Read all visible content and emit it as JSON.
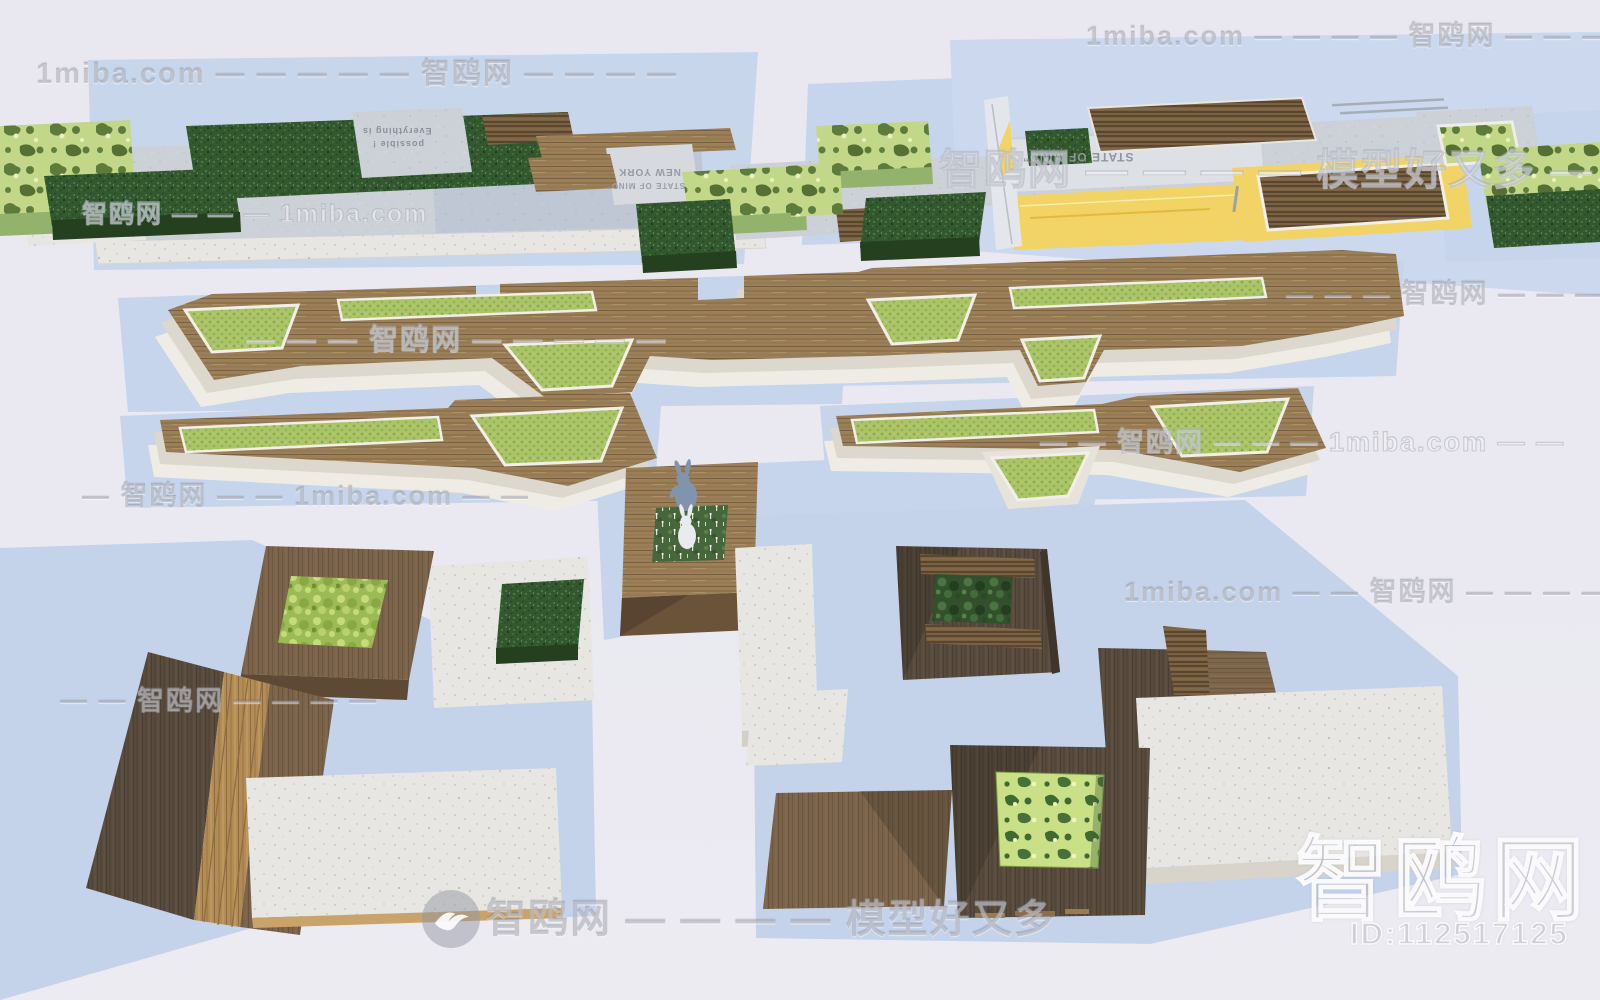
{
  "branding": {
    "site_name": "智鸥网",
    "site_domain": "1miba.com",
    "tagline": "模型好又多",
    "model_id": "ID:112517125",
    "logo_icon": "gull-icon"
  },
  "watermarks": [
    {
      "text": "1miba.com — — — — 智鸥网 — — — —",
      "x": 1086,
      "y": 14,
      "size": 27,
      "style": "gray"
    },
    {
      "text": "1miba.com — — — — — 智鸥网 — — — —",
      "x": 36,
      "y": 50,
      "size": 29,
      "style": "gray"
    },
    {
      "text": "智鸥网 — — — — 模型好又多 — —",
      "x": 940,
      "y": 136,
      "size": 42,
      "style": "outline"
    },
    {
      "text": "智鸥网 — — — 1miba.com",
      "x": 82,
      "y": 194,
      "size": 25,
      "style": "outline"
    },
    {
      "text": "— — — 智鸥网 — — — —",
      "x": 1286,
      "y": 272,
      "size": 27,
      "style": "gray"
    },
    {
      "text": "— — — 智鸥网 — — — — —",
      "x": 246,
      "y": 316,
      "size": 29,
      "style": "outline"
    },
    {
      "text": "— — 智鸥网 — — — 1miba.com — —",
      "x": 1040,
      "y": 420,
      "size": 27,
      "style": "outline"
    },
    {
      "text": "— 智鸥网 — — 1miba.com — —",
      "x": 82,
      "y": 474,
      "size": 27,
      "style": "gray"
    },
    {
      "text": "1miba.com — — 智鸥网 — — — —",
      "x": 1124,
      "y": 570,
      "size": 27,
      "style": "gray"
    },
    {
      "text": "— — 智鸥网 — — — —",
      "x": 60,
      "y": 678,
      "size": 27,
      "style": "gray"
    },
    {
      "text": "智鸥网 — — — — 模型好又多",
      "x": 486,
      "y": 886,
      "size": 40,
      "style": "gray"
    }
  ],
  "structure_labels": [
    {
      "text": "Everything is",
      "x": 362,
      "y": 126,
      "size": 9,
      "rotate": 180,
      "color": "#8a909a"
    },
    {
      "text": "possible !",
      "x": 372,
      "y": 139,
      "size": 9,
      "rotate": 180,
      "color": "#8a909a"
    },
    {
      "text": "NEW YORK",
      "x": 618,
      "y": 166,
      "size": 10,
      "rotate": 180,
      "color": "#959ba5"
    },
    {
      "text": "STATE OF MIND”",
      "x": 606,
      "y": 181,
      "size": 8,
      "rotate": 180,
      "color": "#9aa0a8"
    },
    {
      "text": "STATE OF MIND”",
      "x": 1022,
      "y": 150,
      "size": 12,
      "rotate": 180,
      "color": "#8f959e"
    }
  ],
  "palette": {
    "ground": "#eae9f1",
    "shadow_blue": "#c6d5eb",
    "concrete": "#ccd0d7",
    "terrazzo_white": "#e7e6e3",
    "cream_rim": "#efece5",
    "hedge_dark_green": "#33582f",
    "camo_light_green": "#c3d788",
    "lawn_green": "#abc468",
    "moss_green": "#9dbb54",
    "wood_deck": "#9b7f58",
    "wood_dark": "#5a4d3f",
    "wood_mid": "#7d654a",
    "wood_gold": "#b28b55",
    "accent_yellow": "#f2d365",
    "rabbit_blue": "#8095ad",
    "rabbit_white": "#e9ecef"
  }
}
